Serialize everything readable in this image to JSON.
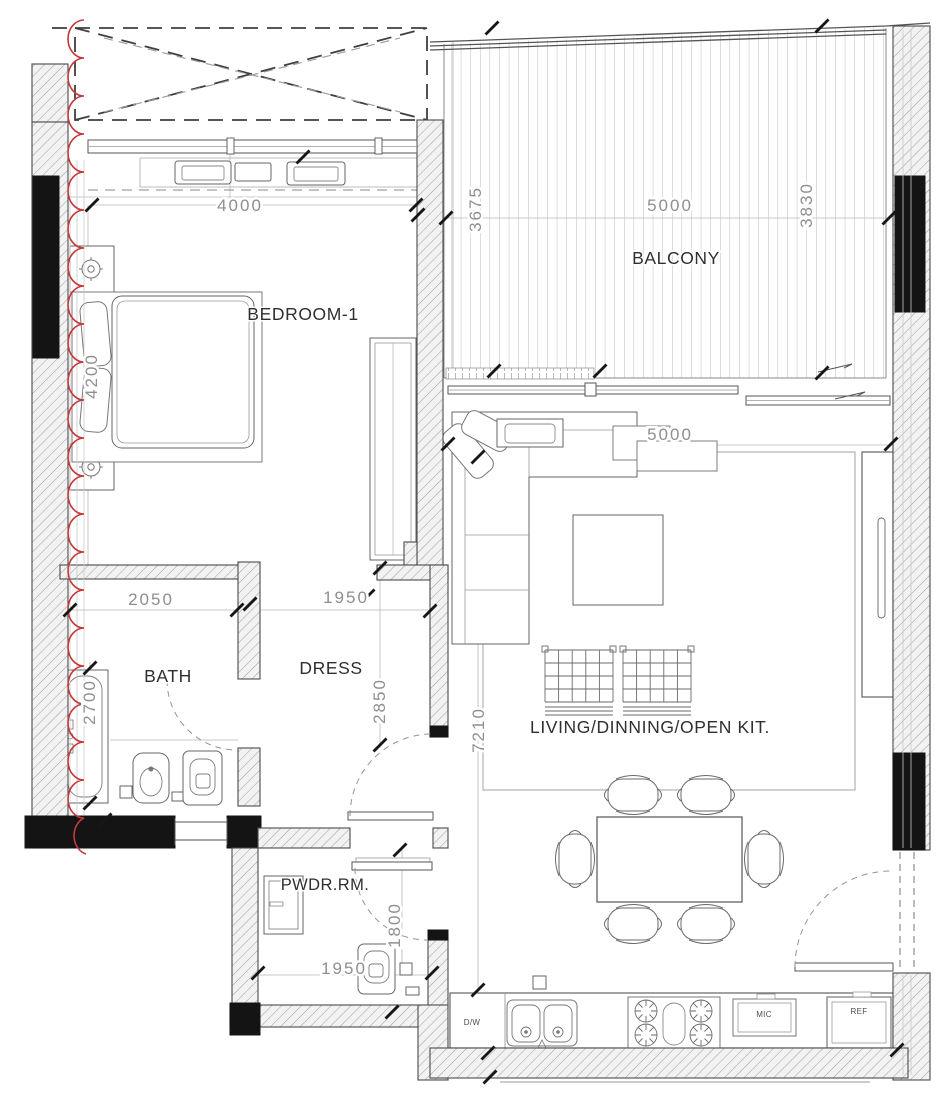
{
  "drawing": {
    "rooms": {
      "bedroom": "BEDROOM-1",
      "balcony": "BALCONY",
      "bath": "BATH",
      "dress": "DRESS",
      "living": "LIVING/DINNING/OPEN KIT.",
      "powder": "PWDR.RM."
    },
    "dims": {
      "bedroom_w": "4000",
      "bedroom_d": "4200",
      "balcony_d_left": "3675",
      "balcony_w": "5000",
      "balcony_d_right": "3830",
      "bath_w": "2050",
      "bath_d": "2700",
      "dress_w": "1950",
      "dress_d": "2850",
      "living_w": "5000",
      "living_d": "7210",
      "powder_w": "1950",
      "powder_d": "1800"
    },
    "appliances": {
      "dishwasher": "D/W",
      "microwave": "MIC",
      "refrigerator": "REF"
    },
    "colors": {
      "revision_cloud": "#c4393c",
      "wall_fill": "#141414",
      "dim_text": "#8f8f8f",
      "label_text": "#2f2f2f"
    }
  }
}
